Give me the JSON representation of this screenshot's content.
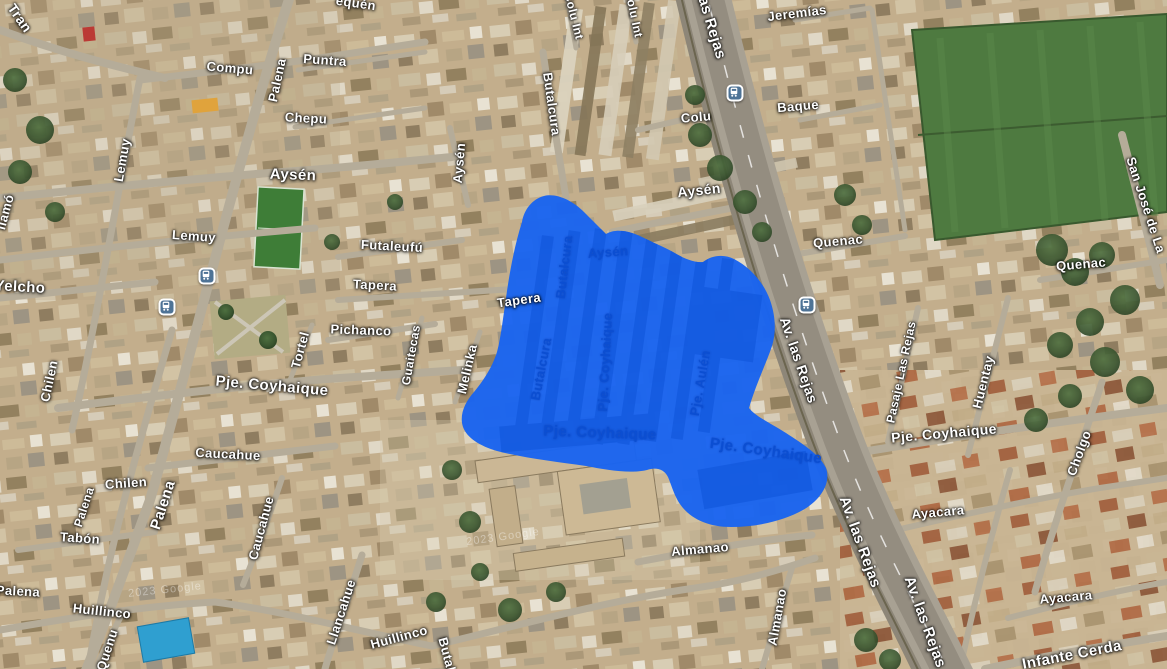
{
  "map": {
    "view_type": "satellite",
    "attribution": "2023 Google",
    "selection": {
      "color": "#1a64f0",
      "shade_color": "#0d52d6",
      "label_color": "#0b4ed2",
      "street_labels": [
        {
          "text": "Aysén",
          "x": 608,
          "y": 252,
          "rot": -4,
          "size": 13
        },
        {
          "text": "Butalcura",
          "x": 564,
          "y": 267,
          "rot": -83,
          "size": 13
        },
        {
          "text": "Butalcura",
          "x": 541,
          "y": 369,
          "rot": -79,
          "size": 13
        },
        {
          "text": "Pje. Coyhaique",
          "x": 605,
          "y": 362,
          "rot": -87,
          "size": 13
        },
        {
          "text": "Pje. Aulén",
          "x": 700,
          "y": 383,
          "rot": -80,
          "size": 13
        },
        {
          "text": "Pje. Coyhaique",
          "x": 600,
          "y": 433,
          "rot": 2,
          "size": 15
        },
        {
          "text": "Pje. Coyhaique",
          "x": 766,
          "y": 451,
          "rot": 8,
          "size": 15
        }
      ]
    },
    "street_labels": [
      {
        "text": "Tran",
        "x": 20,
        "y": 18,
        "rot": 55,
        "size": 14
      },
      {
        "text": "equén",
        "x": 356,
        "y": 3,
        "rot": 8,
        "size": 13
      },
      {
        "text": "Compu",
        "x": 230,
        "y": 68,
        "rot": 5,
        "size": 13
      },
      {
        "text": "Palena",
        "x": 277,
        "y": 80,
        "rot": -78,
        "size": 13
      },
      {
        "text": "Puntra",
        "x": 325,
        "y": 60,
        "rot": 4,
        "size": 13
      },
      {
        "text": "Chepu",
        "x": 306,
        "y": 118,
        "rot": 3,
        "size": 13
      },
      {
        "text": "Aysén",
        "x": 293,
        "y": 175,
        "rot": 2,
        "size": 15
      },
      {
        "text": "Lemuy",
        "x": 122,
        "y": 160,
        "rot": -80,
        "size": 13
      },
      {
        "text": "Lemuy",
        "x": 194,
        "y": 236,
        "rot": 4,
        "size": 13
      },
      {
        "text": "Yelcho",
        "x": 20,
        "y": 287,
        "rot": 3,
        "size": 15
      },
      {
        "text": "llamó",
        "x": 5,
        "y": 212,
        "rot": -75,
        "size": 13
      },
      {
        "text": "Futaleufú",
        "x": 392,
        "y": 246,
        "rot": 3,
        "size": 13
      },
      {
        "text": "Tapera",
        "x": 375,
        "y": 285,
        "rot": 3,
        "size": 13
      },
      {
        "text": "Tapera",
        "x": 519,
        "y": 300,
        "rot": -8,
        "size": 13
      },
      {
        "text": "Pichanco",
        "x": 361,
        "y": 330,
        "rot": 2,
        "size": 13
      },
      {
        "text": "Tortel",
        "x": 300,
        "y": 350,
        "rot": -75,
        "size": 13
      },
      {
        "text": "Pje. Coyhaique",
        "x": 272,
        "y": 386,
        "rot": 5,
        "size": 15
      },
      {
        "text": "Caucahue",
        "x": 228,
        "y": 454,
        "rot": 3,
        "size": 13
      },
      {
        "text": "Chilen",
        "x": 49,
        "y": 381,
        "rot": -78,
        "size": 13
      },
      {
        "text": "Chilen",
        "x": 126,
        "y": 483,
        "rot": -4,
        "size": 13
      },
      {
        "text": "Palena",
        "x": 163,
        "y": 505,
        "rot": -72,
        "size": 15
      },
      {
        "text": "Palena",
        "x": 84,
        "y": 507,
        "rot": -72,
        "size": 12
      },
      {
        "text": "Tabón",
        "x": 80,
        "y": 538,
        "rot": 4,
        "size": 13
      },
      {
        "text": "Palena",
        "x": 18,
        "y": 591,
        "rot": 3,
        "size": 13
      },
      {
        "text": "Huillinco",
        "x": 102,
        "y": 611,
        "rot": 6,
        "size": 13
      },
      {
        "text": "Quenu",
        "x": 107,
        "y": 650,
        "rot": -72,
        "size": 13
      },
      {
        "text": "Caucahue",
        "x": 261,
        "y": 528,
        "rot": -75,
        "size": 13
      },
      {
        "text": "Llancahue",
        "x": 341,
        "y": 612,
        "rot": -72,
        "size": 13
      },
      {
        "text": "Huillinco",
        "x": 399,
        "y": 637,
        "rot": -15,
        "size": 13
      },
      {
        "text": "Butalc",
        "x": 448,
        "y": 658,
        "rot": 75,
        "size": 13
      },
      {
        "text": "Guaitecas",
        "x": 411,
        "y": 355,
        "rot": -80,
        "size": 12
      },
      {
        "text": "Melinka",
        "x": 467,
        "y": 369,
        "rot": -77,
        "size": 13
      },
      {
        "text": "Aysén",
        "x": 459,
        "y": 163,
        "rot": -85,
        "size": 13
      },
      {
        "text": "Butalcura",
        "x": 552,
        "y": 104,
        "rot": 82,
        "size": 13
      },
      {
        "text": "Colu Int",
        "x": 574,
        "y": 16,
        "rot": 76,
        "size": 12
      },
      {
        "text": "Colu Int",
        "x": 634,
        "y": 14,
        "rot": 78,
        "size": 12
      },
      {
        "text": "Colu",
        "x": 696,
        "y": 117,
        "rot": -5,
        "size": 13
      },
      {
        "text": "Aysén",
        "x": 699,
        "y": 190,
        "rot": -6,
        "size": 14
      },
      {
        "text": "as Rejas",
        "x": 712,
        "y": 28,
        "rot": 73,
        "size": 15
      },
      {
        "text": "Jeremías",
        "x": 797,
        "y": 13,
        "rot": -7,
        "size": 13
      },
      {
        "text": "Baque",
        "x": 798,
        "y": 106,
        "rot": -5,
        "size": 13
      },
      {
        "text": "Quenac",
        "x": 838,
        "y": 241,
        "rot": -5,
        "size": 13
      },
      {
        "text": "Quenac",
        "x": 1081,
        "y": 264,
        "rot": -5,
        "size": 13
      },
      {
        "text": "San José de La",
        "x": 1146,
        "y": 205,
        "rot": 72,
        "size": 13
      },
      {
        "text": "Av. las Rejas",
        "x": 799,
        "y": 360,
        "rot": 71,
        "size": 14
      },
      {
        "text": "Pasaje Las Rejas",
        "x": 901,
        "y": 372,
        "rot": -78,
        "size": 12
      },
      {
        "text": "Huentay",
        "x": 983,
        "y": 382,
        "rot": -76,
        "size": 13
      },
      {
        "text": "Pje. Coyhaique",
        "x": 944,
        "y": 433,
        "rot": -5,
        "size": 14
      },
      {
        "text": "Cholgo",
        "x": 1079,
        "y": 453,
        "rot": -70,
        "size": 13
      },
      {
        "text": "Ayacara",
        "x": 938,
        "y": 512,
        "rot": -5,
        "size": 13
      },
      {
        "text": "Ayacara",
        "x": 1066,
        "y": 597,
        "rot": -5,
        "size": 13
      },
      {
        "text": "Av. las Rejas",
        "x": 860,
        "y": 542,
        "rot": 70,
        "size": 15
      },
      {
        "text": "Av. las Rejas",
        "x": 925,
        "y": 622,
        "rot": 70,
        "size": 15
      },
      {
        "text": "Almanao",
        "x": 700,
        "y": 549,
        "rot": -5,
        "size": 13
      },
      {
        "text": "Almanao",
        "x": 777,
        "y": 617,
        "rot": -80,
        "size": 13
      },
      {
        "text": "Infante Cerda",
        "x": 1072,
        "y": 655,
        "rot": -11,
        "size": 15
      }
    ],
    "transit_stops": [
      {
        "x": 207,
        "y": 276
      },
      {
        "x": 167,
        "y": 307
      },
      {
        "x": 735,
        "y": 93
      },
      {
        "x": 807,
        "y": 305
      }
    ],
    "watermarks": [
      {
        "text": "2023 Google",
        "x": 165,
        "y": 590,
        "rot": -6
      },
      {
        "text": "2023 Google",
        "x": 503,
        "y": 537,
        "rot": -8
      }
    ]
  }
}
